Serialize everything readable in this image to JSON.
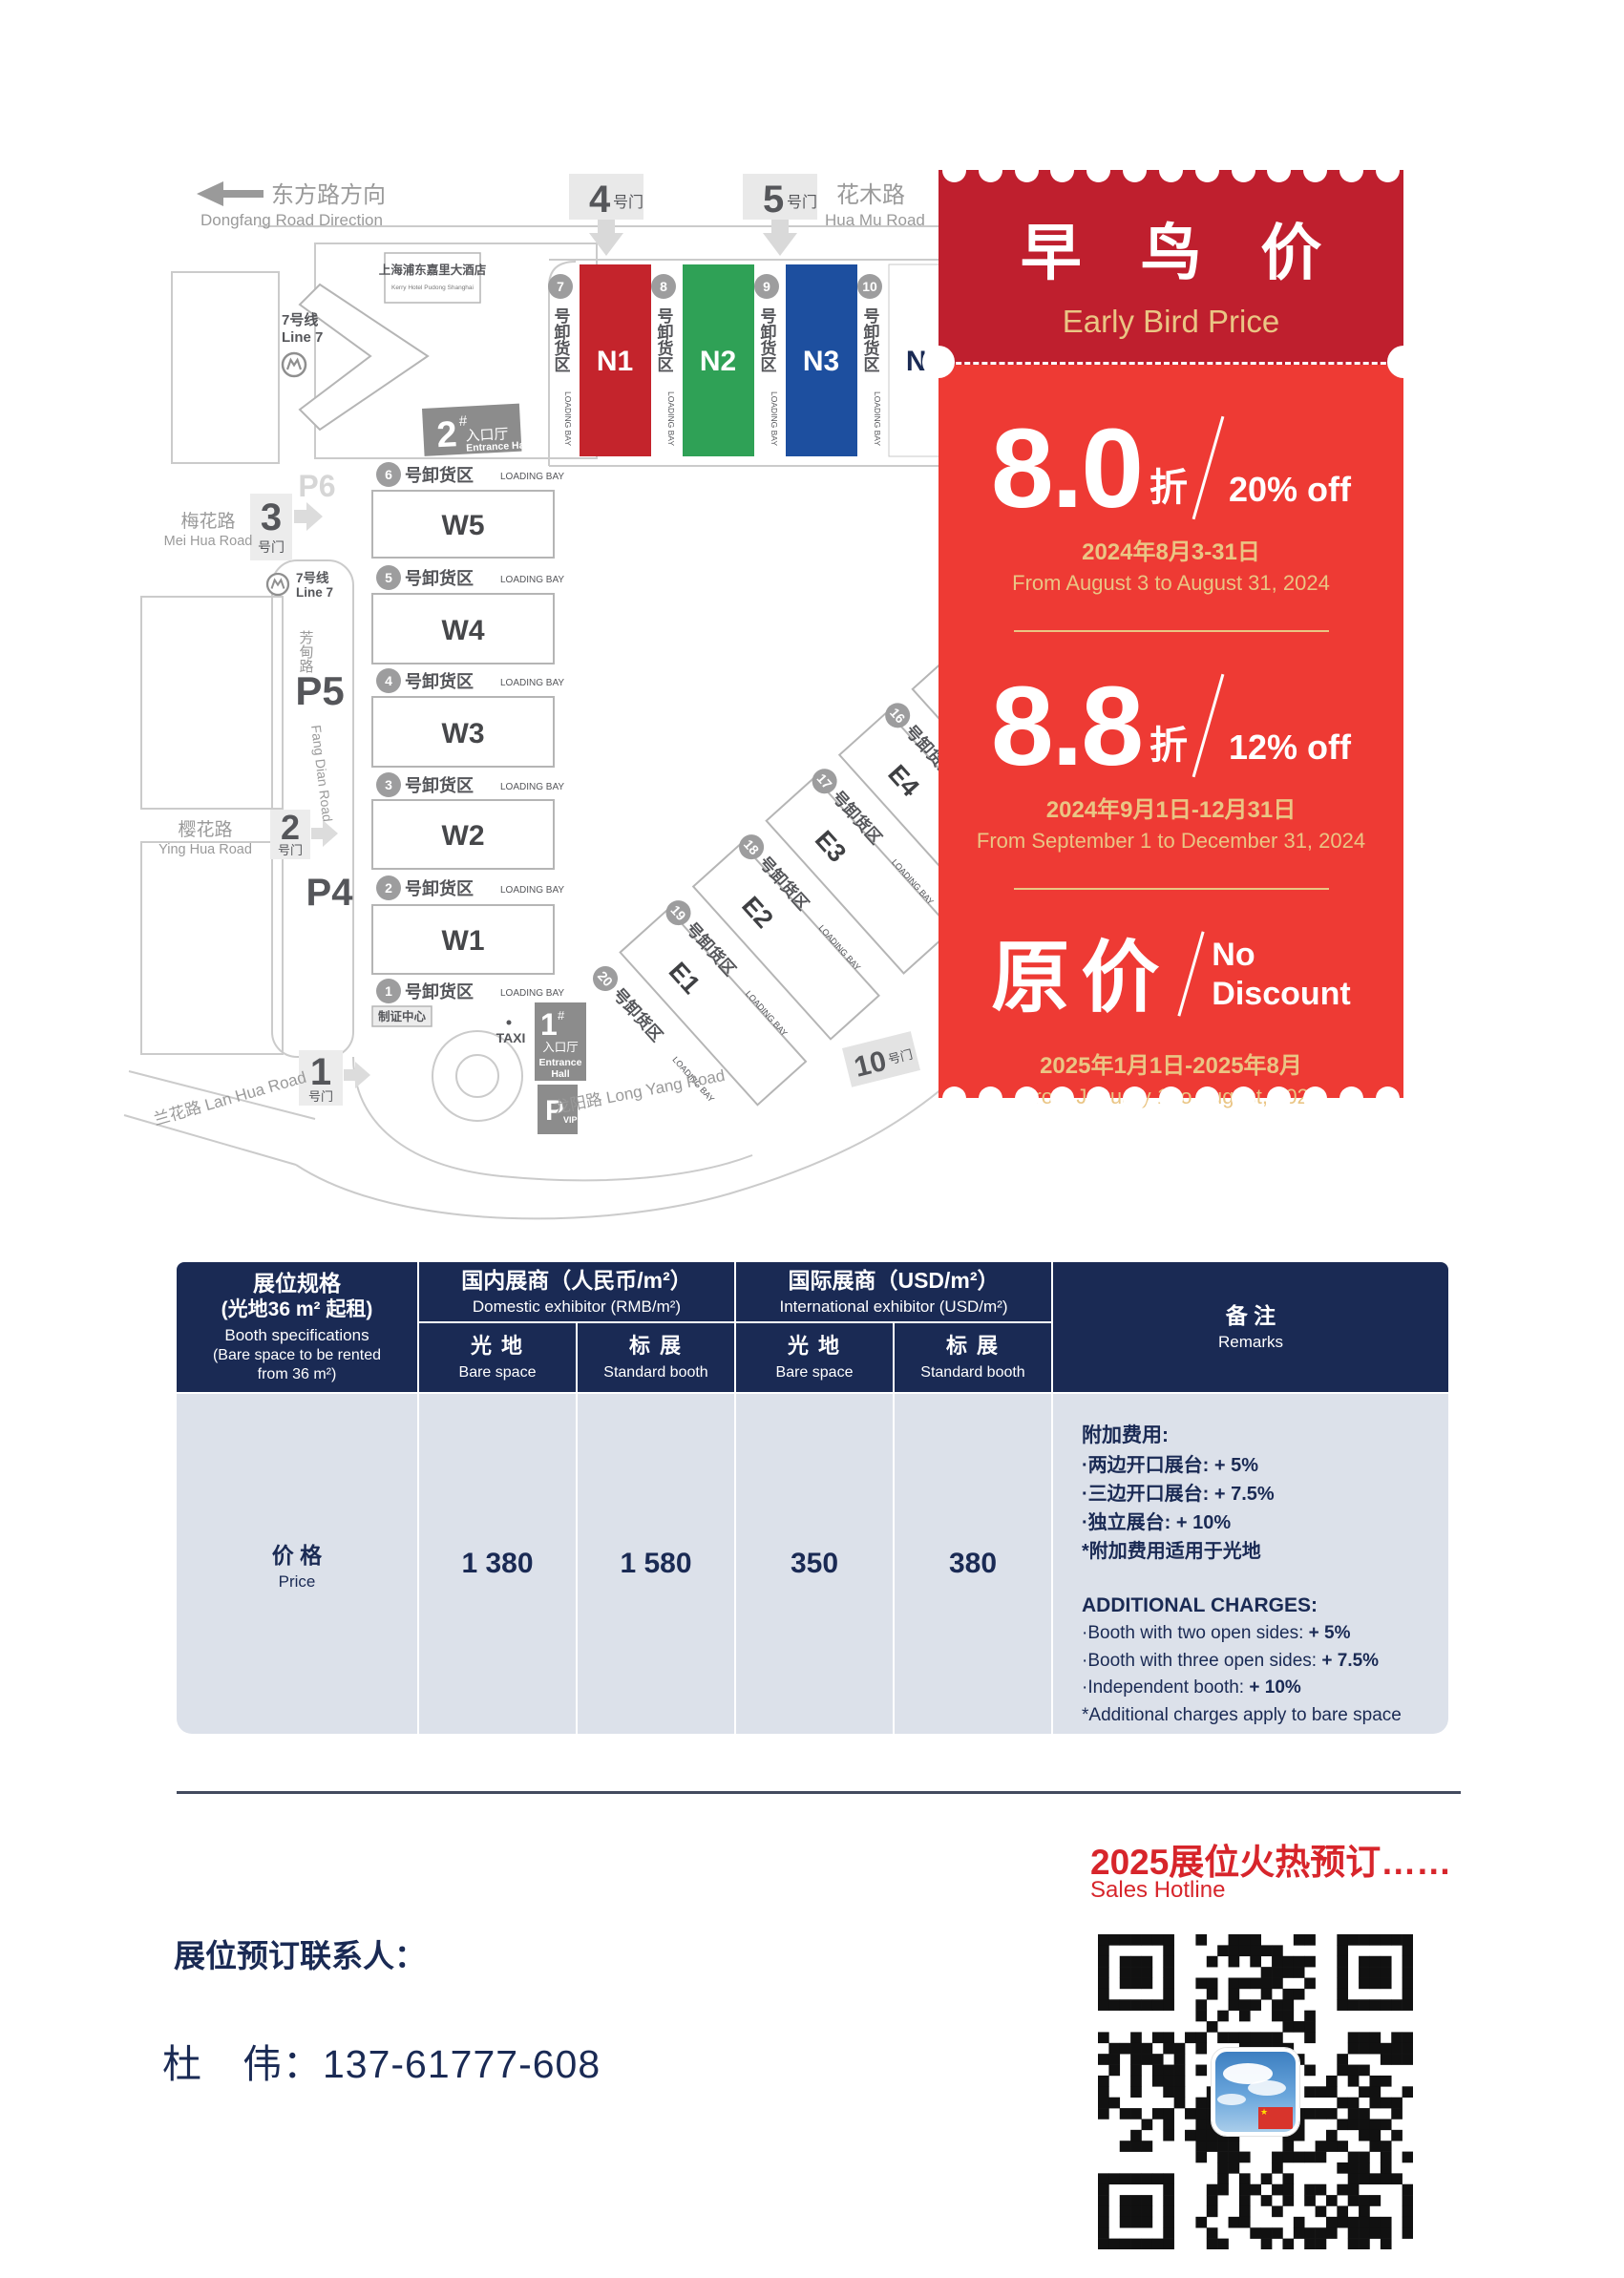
{
  "page": {
    "navy": "#1a2a54",
    "coupon_red": "#ee3a34",
    "coupon_dark_red": "#bf1f2e",
    "gold": "#eac584",
    "accent_red": "#d7252b"
  },
  "map": {
    "direction_cn": "东方路方向",
    "direction_en": "Dongfang Road Direction",
    "gate_suffix": "号门",
    "gate1": "1",
    "gate2": "2",
    "gate3": "3",
    "gate4": "4",
    "gate5": "5",
    "gate10": "10",
    "huamu_cn": "花木路",
    "huamu_en": "Hua Mu Road",
    "meihua_cn": "梅花路",
    "meihua_en": "Mei Hua Road",
    "fangdian_cn": "芳甸路",
    "fangdian_en": "Fang Dian Road",
    "yinghua_cn": "樱花路",
    "yinghua_en": "Ying Hua Road",
    "lanhua": "兰花路 Lan Hua Road",
    "longyang": "龙阳路  Long Yang Road",
    "hotel_cn": "上海浦东嘉里大酒店",
    "hotel_en": "Kerry Hotel Pudong Shanghai",
    "line7_cn": "7号线",
    "line7_en": "Line 7",
    "hash": "#",
    "entrance2": "2",
    "entrance1": "1",
    "entrance_cn": "入口厅",
    "entrance_en": "Entrance Hall",
    "entrance_en1": "Entrance",
    "entrance_en2": "Hall",
    "loading_cn": "号卸货区",
    "loading_en": "LOADING BAY",
    "badge_center": "制证中心",
    "taxi": "TAXI",
    "p_letter": "P",
    "p_vip": "VIP",
    "p4": "P4",
    "p5": "P5",
    "p6": "P6",
    "halls_n": [
      {
        "label": "N1",
        "fill": "#c4242c",
        "text": "#ffffff"
      },
      {
        "label": "N2",
        "fill": "#2fa156",
        "text": "#ffffff"
      },
      {
        "label": "N3",
        "fill": "#1d4f9f",
        "text": "#ffffff"
      },
      {
        "label": "N4",
        "fill": "#ffffff",
        "text": "#1a2a54"
      }
    ],
    "halls_w": [
      "W5",
      "W4",
      "W3",
      "W2",
      "W1"
    ],
    "halls_e": [
      "E1",
      "E2",
      "E3",
      "E4"
    ],
    "bays_n": [
      "7",
      "8",
      "9",
      "10"
    ],
    "bays_w": [
      "6",
      "5",
      "4",
      "3",
      "2",
      "1"
    ],
    "bays_e": [
      "20",
      "19",
      "18",
      "17",
      "16"
    ]
  },
  "coupon": {
    "title_cn": "早 鸟 价",
    "title_en": "Early Bird Price",
    "tier1": {
      "value": "8.0",
      "unit": "折",
      "discount": "20% off",
      "date_cn": "2024年8月3-31日",
      "date_en": "From August 3 to August 31, 2024"
    },
    "tier2": {
      "value": "8.8",
      "unit": "折",
      "discount": "12% off",
      "date_cn": "2024年9月1日-12月31日",
      "date_en": "From September 1 to December 31, 2024"
    },
    "tier3": {
      "value": "原价",
      "no_1": "No",
      "no_2": "Discount",
      "date_cn": "2025年1月1日-2025年8月",
      "date_en": "From January 1 to August, 2025"
    }
  },
  "table": {
    "spec_cn_1": "展位规格",
    "spec_cn_2": "(光地36 m² 起租)",
    "spec_en_1": "Booth specifications",
    "spec_en_2": "(Bare space to be rented",
    "spec_en_3": "from 36 m²)",
    "dom_cn": "国内展商（人民币/m²）",
    "dom_en": "Domestic exhibitor (RMB/m²)",
    "intl_cn": "国际展商（USD/m²）",
    "intl_en": "International exhibitor (USD/m²)",
    "bare_cn": "光 地",
    "bare_en": "Bare space",
    "std_cn": "标 展",
    "std_en": "Standard booth",
    "remarks_cn": "备 注",
    "remarks_en": "Remarks",
    "price_cn": "价 格",
    "price_en": "Price",
    "prices": [
      "1 380",
      "1 580",
      "350",
      "380"
    ],
    "remarks_cn_title": "附加费用:",
    "remarks_cn_items": [
      {
        "t": "·两边开口展台: ",
        "v": "+ 5%"
      },
      {
        "t": "·三边开口展台: ",
        "v": "+ 7.5%"
      },
      {
        "t": "·独立展台: ",
        "v": "+ 10%"
      },
      {
        "t": "*附加费用适用于光地",
        "v": ""
      }
    ],
    "remarks_en_title": "ADDITIONAL CHARGES:",
    "remarks_en_items": [
      {
        "t": "·Booth with two open sides: ",
        "v": "+ 5%"
      },
      {
        "t": "·Booth with three open sides: ",
        "v": "+ 7.5%"
      },
      {
        "t": "·Independent booth: ",
        "v": "+ 10%"
      },
      {
        "t": "*Additional charges apply to bare space",
        "v": ""
      }
    ]
  },
  "footer": {
    "hotline_cn": "2025展位火热预订……",
    "hotline_en": "Sales Hotline",
    "contact_label": "展位预订联系人：",
    "contact": "杜　伟：137-61777-608"
  }
}
